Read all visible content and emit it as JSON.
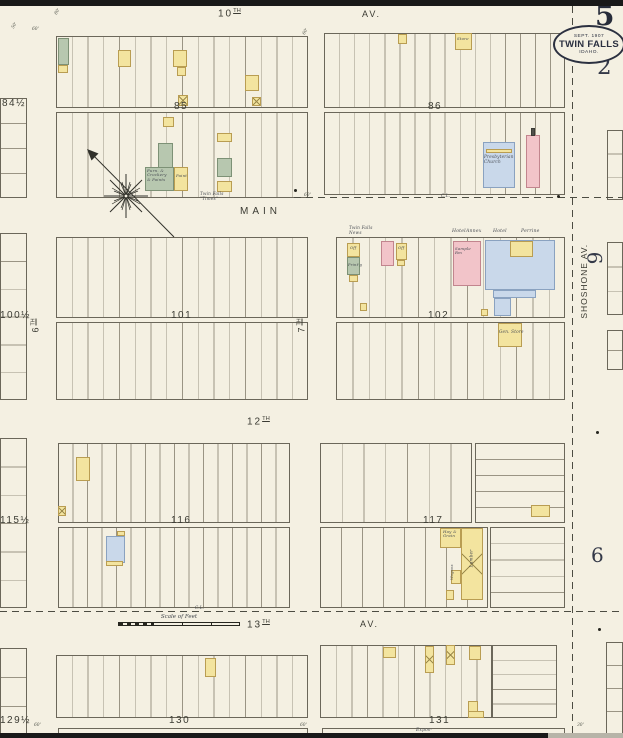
{
  "stamp": {
    "sheet": "5",
    "page": "2",
    "line1": "SEPT. 1907",
    "line2": "TWIN FALLS",
    "line3": "IDAHO."
  },
  "margin": {
    "six_upper": "6",
    "six_lower": "6"
  },
  "scale_bar": {
    "label": "Scale of Feet"
  },
  "palette": {
    "paper": "#f4f0e2",
    "ink": "#3c3c33",
    "yellow": "#f3e49f",
    "pink": "#f2c4c9",
    "blue": "#c9d8ea",
    "green": "#b7c7af"
  },
  "streets": [
    {
      "id": "10th",
      "label": "10",
      "sup": "TH",
      "x": 218,
      "y": 9,
      "size": 10,
      "ls": 2
    },
    {
      "id": "10th-av",
      "label": "AV.",
      "x": 362,
      "y": 10,
      "size": 9,
      "ls": 2
    },
    {
      "id": "main",
      "label": "MAIN",
      "x": 240,
      "y": 207,
      "size": 10,
      "ls": 4
    },
    {
      "id": "12th",
      "label": "12",
      "sup": "TH",
      "x": 247,
      "y": 417,
      "size": 10,
      "ls": 2
    },
    {
      "id": "13th",
      "label": "13",
      "sup": "TH",
      "x": 247,
      "y": 620,
      "size": 10,
      "ls": 2
    },
    {
      "id": "13th-av",
      "label": "AV.",
      "x": 360,
      "y": 620,
      "size": 9,
      "ls": 2
    },
    {
      "id": "shoshone-av",
      "label": "SHOSHONE  AV.",
      "x": 539,
      "y": 277,
      "size": 8.5,
      "ls": 1,
      "rot": -90,
      "w": 90
    },
    {
      "id": "6th",
      "label": "6",
      "sup": "TH",
      "x": 21,
      "y": 321,
      "size": 9,
      "rot": -90,
      "w": 30
    },
    {
      "id": "7th",
      "label": "7",
      "sup": "TH",
      "x": 287,
      "y": 321,
      "size": 9,
      "rot": -90,
      "w": 30
    }
  ],
  "block_labels": [
    {
      "t": "85",
      "x": 174,
      "y": 102
    },
    {
      "t": "86",
      "x": 428,
      "y": 102
    },
    {
      "t": "84½",
      "x": 2,
      "y": 99
    },
    {
      "t": "101",
      "x": 171,
      "y": 311
    },
    {
      "t": "102",
      "x": 428,
      "y": 311
    },
    {
      "t": "100½",
      "x": 0,
      "y": 311
    },
    {
      "t": "116",
      "x": 171,
      "y": 516
    },
    {
      "t": "117",
      "x": 423,
      "y": 516
    },
    {
      "t": "115½",
      "x": 0,
      "y": 516
    },
    {
      "t": "130",
      "x": 169,
      "y": 716
    },
    {
      "t": "131",
      "x": 429,
      "y": 716
    },
    {
      "t": "129½",
      "x": 0,
      "y": 716
    }
  ],
  "blocks": [
    {
      "x": 56,
      "y": 36,
      "w": 252,
      "h": 72,
      "n": 16,
      "dir": "v"
    },
    {
      "x": 56,
      "y": 112,
      "w": 252,
      "h": 86,
      "n": 16,
      "dir": "v"
    },
    {
      "x": 324,
      "y": 33,
      "w": 241,
      "h": 75,
      "n": 16,
      "dir": "v"
    },
    {
      "x": 324,
      "y": 112,
      "w": 241,
      "h": 83,
      "n": 16,
      "dir": "v"
    },
    {
      "x": 56,
      "y": 237,
      "w": 252,
      "h": 81,
      "n": 16,
      "dir": "v"
    },
    {
      "x": 56,
      "y": 322,
      "w": 252,
      "h": 78,
      "n": 16,
      "dir": "v"
    },
    {
      "x": 336,
      "y": 237,
      "w": 229,
      "h": 81,
      "n": 14,
      "dir": "v"
    },
    {
      "x": 336,
      "y": 322,
      "w": 229,
      "h": 78,
      "n": 14,
      "dir": "v"
    },
    {
      "x": 58,
      "y": 443,
      "w": 232,
      "h": 80,
      "n": 16,
      "dir": "v"
    },
    {
      "x": 58,
      "y": 527,
      "w": 232,
      "h": 81,
      "n": 16,
      "dir": "v"
    },
    {
      "x": 320,
      "y": 443,
      "w": 152,
      "h": 80,
      "n": 7,
      "dir": "v"
    },
    {
      "x": 475,
      "y": 443,
      "w": 90,
      "h": 80,
      "n": 5,
      "dir": "h"
    },
    {
      "x": 320,
      "y": 527,
      "w": 168,
      "h": 81,
      "n": 8,
      "dir": "v"
    },
    {
      "x": 490,
      "y": 527,
      "w": 75,
      "h": 81,
      "n": 5,
      "dir": "h"
    },
    {
      "x": 56,
      "y": 655,
      "w": 252,
      "h": 63,
      "n": 16,
      "dir": "v"
    },
    {
      "x": 58,
      "y": 728,
      "w": 250,
      "h": 9,
      "n": 1,
      "dir": "v"
    },
    {
      "x": 320,
      "y": 645,
      "w": 172,
      "h": 73,
      "n": 11,
      "dir": "v"
    },
    {
      "x": 492,
      "y": 645,
      "w": 65,
      "h": 73,
      "n": 5,
      "dir": "h"
    },
    {
      "x": 322,
      "y": 728,
      "w": 243,
      "h": 9,
      "n": 1,
      "dir": "v"
    },
    {
      "x": 0,
      "y": 98,
      "w": 27,
      "h": 100,
      "n": 4,
      "dir": "h"
    },
    {
      "x": 0,
      "y": 233,
      "w": 27,
      "h": 167,
      "n": 6,
      "dir": "h"
    },
    {
      "x": 0,
      "y": 438,
      "w": 27,
      "h": 170,
      "n": 6,
      "dir": "h"
    },
    {
      "x": 0,
      "y": 648,
      "w": 27,
      "h": 87,
      "n": 3,
      "dir": "h"
    },
    {
      "x": 607,
      "y": 130,
      "w": 16,
      "h": 70,
      "n": 3,
      "dir": "h"
    },
    {
      "x": 607,
      "y": 242,
      "w": 16,
      "h": 73,
      "n": 3,
      "dir": "h"
    },
    {
      "x": 607,
      "y": 330,
      "w": 16,
      "h": 40,
      "n": 2,
      "dir": "h"
    },
    {
      "x": 606,
      "y": 642,
      "w": 17,
      "h": 92,
      "n": 4,
      "dir": "h"
    }
  ],
  "buildings": [
    {
      "x": 58,
      "y": 38,
      "w": 11,
      "h": 27,
      "c": "g"
    },
    {
      "x": 58,
      "y": 65,
      "w": 10,
      "h": 8,
      "c": "y"
    },
    {
      "x": 118,
      "y": 50,
      "w": 13,
      "h": 17,
      "c": "y"
    },
    {
      "x": 173,
      "y": 50,
      "w": 14,
      "h": 17,
      "c": "y"
    },
    {
      "x": 177,
      "y": 67,
      "w": 9,
      "h": 9,
      "c": "y"
    },
    {
      "x": 245,
      "y": 75,
      "w": 14,
      "h": 16,
      "c": "y"
    },
    {
      "x": 178,
      "y": 95,
      "w": 10,
      "h": 11,
      "c": "y",
      "hx": true
    },
    {
      "x": 252,
      "y": 97,
      "w": 9,
      "h": 9,
      "c": "y",
      "hx": true
    },
    {
      "x": 163,
      "y": 117,
      "w": 11,
      "h": 10,
      "c": "y"
    },
    {
      "x": 158,
      "y": 143,
      "w": 15,
      "h": 25,
      "c": "g"
    },
    {
      "x": 145,
      "y": 167,
      "w": 29,
      "h": 24,
      "c": "g"
    },
    {
      "x": 174,
      "y": 167,
      "w": 14,
      "h": 24,
      "c": "y"
    },
    {
      "x": 217,
      "y": 133,
      "w": 15,
      "h": 9,
      "c": "y"
    },
    {
      "x": 217,
      "y": 158,
      "w": 15,
      "h": 19,
      "c": "g"
    },
    {
      "x": 217,
      "y": 181,
      "w": 15,
      "h": 11,
      "c": "y"
    },
    {
      "x": 398,
      "y": 34,
      "w": 9,
      "h": 10,
      "c": "y"
    },
    {
      "x": 455,
      "y": 33,
      "w": 17,
      "h": 17,
      "c": "y"
    },
    {
      "x": 483,
      "y": 142,
      "w": 32,
      "h": 46,
      "c": "b"
    },
    {
      "x": 486,
      "y": 149,
      "w": 26,
      "h": 4,
      "c": "y"
    },
    {
      "x": 526,
      "y": 135,
      "w": 14,
      "h": 53,
      "c": "p"
    },
    {
      "x": 531,
      "y": 128,
      "w": 4,
      "h": 8,
      "c": "d"
    },
    {
      "x": 347,
      "y": 243,
      "w": 13,
      "h": 14,
      "c": "y"
    },
    {
      "x": 347,
      "y": 257,
      "w": 13,
      "h": 18,
      "c": "g"
    },
    {
      "x": 349,
      "y": 275,
      "w": 9,
      "h": 7,
      "c": "y"
    },
    {
      "x": 381,
      "y": 241,
      "w": 13,
      "h": 25,
      "c": "p"
    },
    {
      "x": 396,
      "y": 243,
      "w": 11,
      "h": 17,
      "c": "y"
    },
    {
      "x": 397,
      "y": 260,
      "w": 8,
      "h": 6,
      "c": "y"
    },
    {
      "x": 360,
      "y": 303,
      "w": 7,
      "h": 8,
      "c": "y"
    },
    {
      "x": 453,
      "y": 241,
      "w": 28,
      "h": 45,
      "c": "p"
    },
    {
      "x": 485,
      "y": 240,
      "w": 70,
      "h": 50,
      "c": "b"
    },
    {
      "x": 510,
      "y": 241,
      "w": 23,
      "h": 16,
      "c": "y"
    },
    {
      "x": 493,
      "y": 290,
      "w": 43,
      "h": 8,
      "c": "b"
    },
    {
      "x": 494,
      "y": 298,
      "w": 17,
      "h": 18,
      "c": "b"
    },
    {
      "x": 481,
      "y": 309,
      "w": 7,
      "h": 7,
      "c": "y"
    },
    {
      "x": 498,
      "y": 323,
      "w": 24,
      "h": 24,
      "c": "y"
    },
    {
      "x": 76,
      "y": 457,
      "w": 14,
      "h": 24,
      "c": "y"
    },
    {
      "x": 58,
      "y": 506,
      "w": 8,
      "h": 10,
      "c": "y",
      "hx": true
    },
    {
      "x": 106,
      "y": 536,
      "w": 19,
      "h": 27,
      "c": "b"
    },
    {
      "x": 106,
      "y": 561,
      "w": 17,
      "h": 5,
      "c": "y"
    },
    {
      "x": 117,
      "y": 531,
      "w": 8,
      "h": 5,
      "c": "y"
    },
    {
      "x": 531,
      "y": 505,
      "w": 19,
      "h": 12,
      "c": "y"
    },
    {
      "x": 440,
      "y": 528,
      "w": 21,
      "h": 20,
      "c": "y"
    },
    {
      "x": 461,
      "y": 528,
      "w": 22,
      "h": 72,
      "c": "y",
      "hx": true
    },
    {
      "x": 451,
      "y": 570,
      "w": 10,
      "h": 14,
      "c": "y"
    },
    {
      "x": 446,
      "y": 590,
      "w": 8,
      "h": 10,
      "c": "y"
    },
    {
      "x": 205,
      "y": 658,
      "w": 11,
      "h": 19,
      "c": "y"
    },
    {
      "x": 383,
      "y": 647,
      "w": 13,
      "h": 11,
      "c": "y"
    },
    {
      "x": 425,
      "y": 646,
      "w": 9,
      "h": 27,
      "c": "y",
      "hx": true
    },
    {
      "x": 446,
      "y": 645,
      "w": 9,
      "h": 20,
      "c": "y",
      "hx": true
    },
    {
      "x": 469,
      "y": 646,
      "w": 12,
      "h": 14,
      "c": "y"
    },
    {
      "x": 468,
      "y": 701,
      "w": 10,
      "h": 17,
      "c": "y"
    },
    {
      "x": 468,
      "y": 711,
      "w": 16,
      "h": 7,
      "c": "y"
    }
  ],
  "annotations": [
    {
      "t": "Twin Falls\n\"Times\"",
      "x": 200,
      "y": 192,
      "s": 4.2
    },
    {
      "t": "Twin Falls\nNews",
      "x": 349,
      "y": 226,
      "s": 4.2
    },
    {
      "t": "Hotel",
      "x": 452,
      "y": 229,
      "s": 4.6
    },
    {
      "t": "Annex",
      "x": 466,
      "y": 229,
      "s": 4.6
    },
    {
      "t": "Hotel",
      "x": 493,
      "y": 229,
      "s": 4.6
    },
    {
      "t": "Perrine",
      "x": 521,
      "y": 229,
      "s": 4.6
    },
    {
      "t": "Presbyterian\nChurch",
      "x": 484,
      "y": 155,
      "s": 4.2
    },
    {
      "t": "Furn. &\nCrockery\n& Paints",
      "x": 147,
      "y": 169,
      "s": 3.9
    },
    {
      "t": "Paint",
      "x": 176,
      "y": 174,
      "s": 3.9
    },
    {
      "t": "Store",
      "x": 457,
      "y": 37,
      "s": 3.9
    },
    {
      "t": "Sample\nRm",
      "x": 455,
      "y": 247,
      "s": 3.9
    },
    {
      "t": "Off",
      "x": 350,
      "y": 246,
      "s": 3.7
    },
    {
      "t": "Print'g",
      "x": 348,
      "y": 263,
      "s": 3.7
    },
    {
      "t": "Off",
      "x": 398,
      "y": 246,
      "s": 3.7
    },
    {
      "t": "Gen. Store",
      "x": 499,
      "y": 330,
      "s": 4.2
    },
    {
      "t": "Hay &\nGrain",
      "x": 443,
      "y": 530,
      "s": 3.9
    },
    {
      "t": "Lumber",
      "x": 458,
      "y": 556,
      "s": 4.2,
      "rot": -90,
      "w": 28
    },
    {
      "t": "Wagons",
      "x": 438,
      "y": 570,
      "s": 3.7,
      "rot": -90,
      "w": 28
    },
    {
      "t": "Expos-",
      "x": 416,
      "y": 728,
      "s": 4.4
    },
    {
      "t": "C.L.",
      "x": 195,
      "y": 606,
      "s": 4.2
    },
    {
      "t": "C.L.",
      "x": 441,
      "y": 194,
      "s": 4.2
    }
  ],
  "edge_marks": [
    {
      "t": "50'",
      "x": 12,
      "y": 24,
      "r": -60
    },
    {
      "t": "60'",
      "x": 32,
      "y": 28,
      "r": 0
    },
    {
      "t": "80'",
      "x": 55,
      "y": 10,
      "r": -60
    },
    {
      "t": "60'",
      "x": 303,
      "y": 30,
      "r": -60
    },
    {
      "t": "60'",
      "x": 304,
      "y": 194,
      "r": 0
    },
    {
      "t": "60'",
      "x": 34,
      "y": 724,
      "r": 0
    },
    {
      "t": "60'",
      "x": 300,
      "y": 724,
      "r": 0
    },
    {
      "t": "30'",
      "x": 577,
      "y": 724,
      "r": 0
    }
  ],
  "dashed_lines": [
    {
      "x": 294,
      "y": 197,
      "len": 329,
      "dir": "h"
    },
    {
      "x": 0,
      "y": 611,
      "len": 623,
      "dir": "h"
    },
    {
      "x": 572,
      "y": 6,
      "len": 727,
      "dir": "v"
    }
  ],
  "dots": [
    {
      "x": 557,
      "y": 195
    },
    {
      "x": 294,
      "y": 189
    },
    {
      "x": 596,
      "y": 431
    },
    {
      "x": 598,
      "y": 628
    }
  ]
}
